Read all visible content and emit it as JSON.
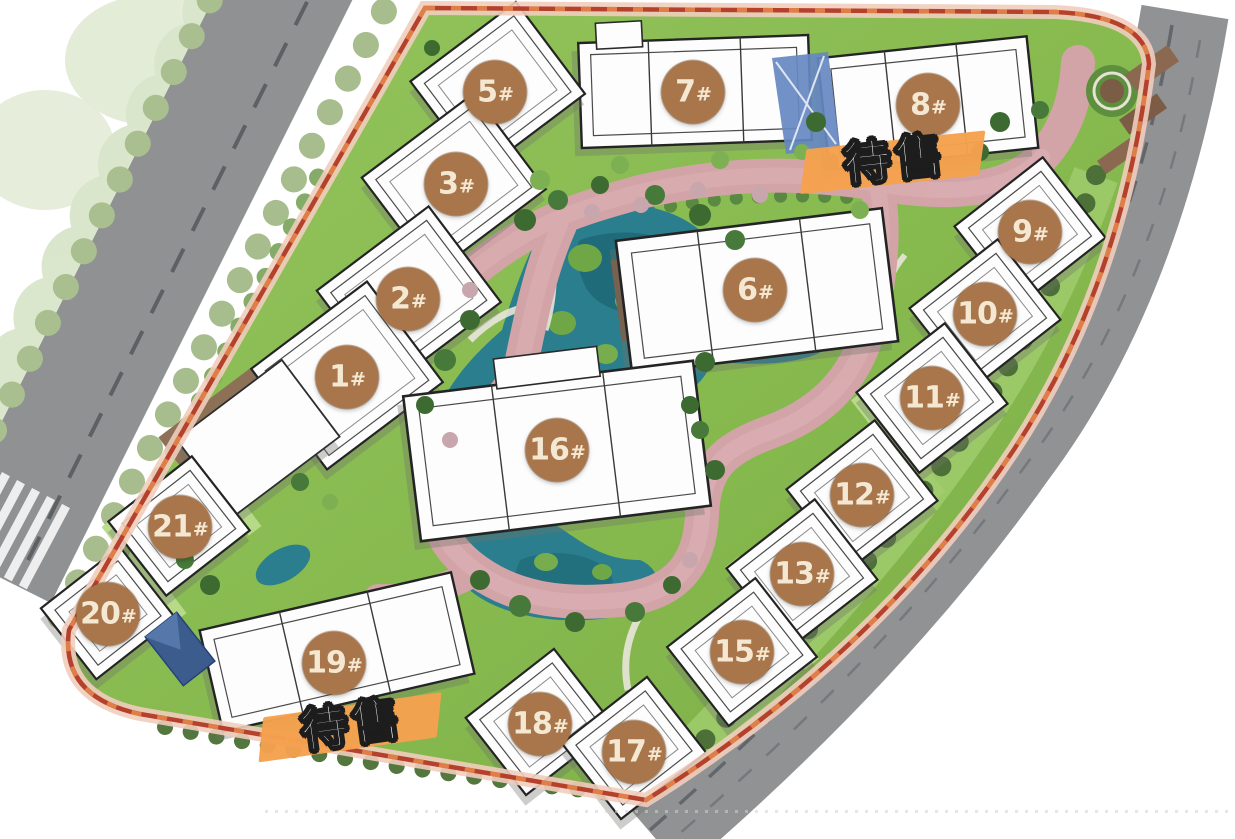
{
  "scene": {
    "type": "residential-master-plan",
    "description": "Bird's-eye site plan of a residential compound with numbered buildings, central lake, loop road and perimeter streets"
  },
  "badges": [
    {
      "num": "1",
      "hash": "#",
      "x": 347,
      "y": 377
    },
    {
      "num": "2",
      "hash": "#",
      "x": 408,
      "y": 299
    },
    {
      "num": "3",
      "hash": "#",
      "x": 456,
      "y": 184
    },
    {
      "num": "5",
      "hash": "#",
      "x": 495,
      "y": 92
    },
    {
      "num": "6",
      "hash": "#",
      "x": 755,
      "y": 290
    },
    {
      "num": "7",
      "hash": "#",
      "x": 693,
      "y": 92
    },
    {
      "num": "8",
      "hash": "#",
      "x": 928,
      "y": 105
    },
    {
      "num": "9",
      "hash": "#",
      "x": 1030,
      "y": 232
    },
    {
      "num": "10",
      "hash": "#",
      "x": 985,
      "y": 314
    },
    {
      "num": "11",
      "hash": "#",
      "x": 932,
      "y": 398
    },
    {
      "num": "12",
      "hash": "#",
      "x": 862,
      "y": 495
    },
    {
      "num": "13",
      "hash": "#",
      "x": 802,
      "y": 574
    },
    {
      "num": "15",
      "hash": "#",
      "x": 742,
      "y": 652
    },
    {
      "num": "16",
      "hash": "#",
      "x": 557,
      "y": 450
    },
    {
      "num": "17",
      "hash": "#",
      "x": 634,
      "y": 752
    },
    {
      "num": "18",
      "hash": "#",
      "x": 540,
      "y": 724
    },
    {
      "num": "19",
      "hash": "#",
      "x": 334,
      "y": 663
    },
    {
      "num": "20",
      "hash": "#",
      "x": 108,
      "y": 614
    },
    {
      "num": "21",
      "hash": "#",
      "x": 180,
      "y": 527
    }
  ],
  "sale_labels": [
    {
      "text": "待售",
      "x": 895,
      "y": 155,
      "transform": "translate(-50%,-50%) rotate(-6deg)"
    },
    {
      "text": "待售",
      "x": 352,
      "y": 720,
      "transform": "translate(-50%,-50%) rotate(-8deg)"
    }
  ],
  "colors": {
    "badge_brown": "#a8764a",
    "badge_text": "#f4e8d3",
    "sale_bar_orange": "#f5a14e",
    "sale_text": "#ffffff",
    "water_teal": "#2a7e8d",
    "internal_road_pink": "#d2a4a8",
    "grass_green": "#86b94e",
    "boundary_red": "#b5402c",
    "perimeter_road_gray": "#909294",
    "building_fill": "#fdfdfd"
  }
}
